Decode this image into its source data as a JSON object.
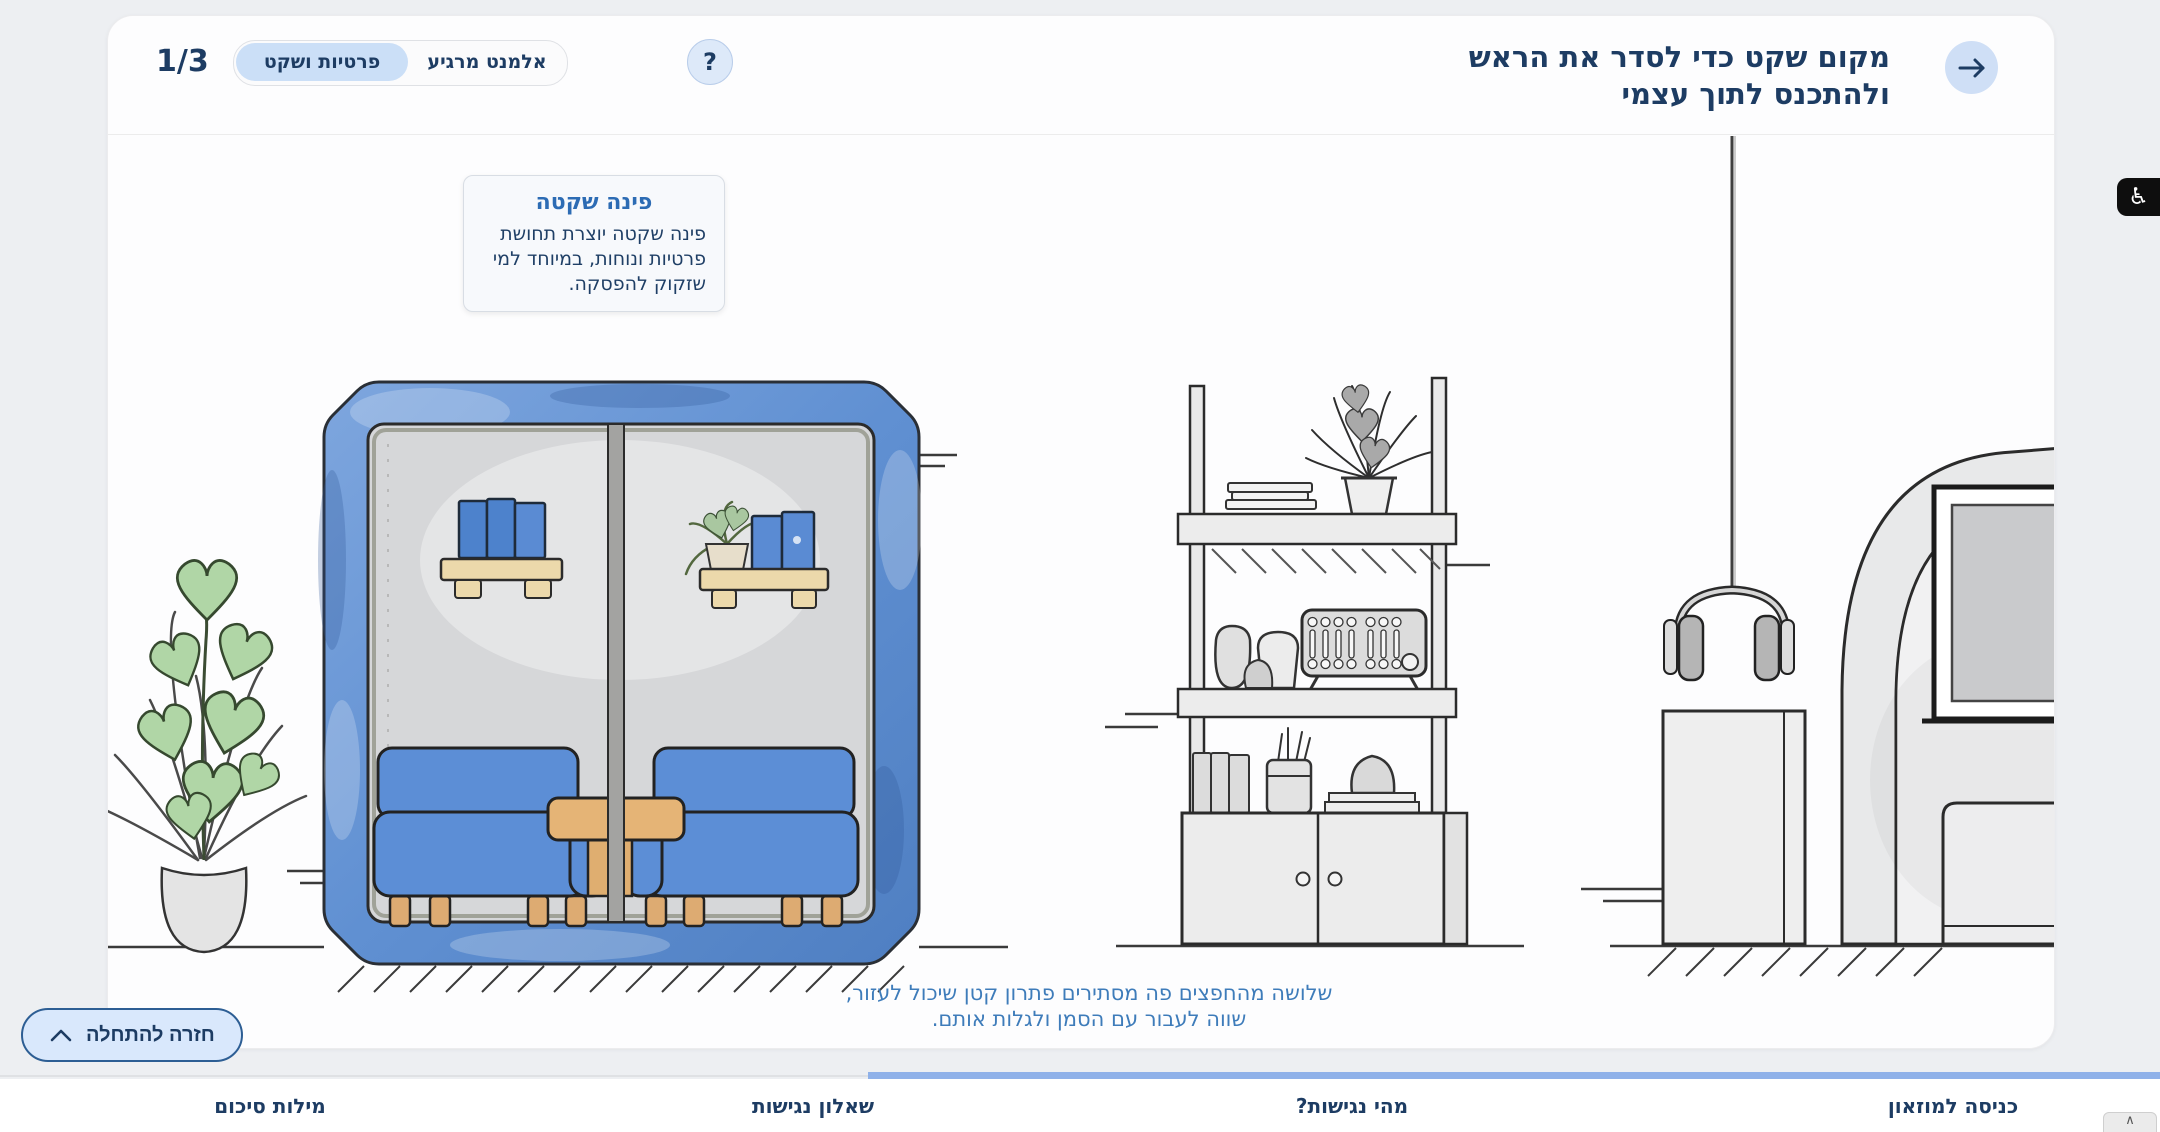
{
  "app": {
    "language": "he",
    "direction": "rtl"
  },
  "colors": {
    "page_bg": "#edeff2",
    "card_bg": "#fdfdfe",
    "primary_text": "#1d3c63",
    "tooltip_title_blue": "#2d6cb4",
    "caption_blue": "#3e7cba",
    "toggle_active_bg": "#cbdff7",
    "back_button_bg": "#d9e8fc",
    "back_button_border": "#2d5e94",
    "progress_blue": "#8fb1e9",
    "booth_blue": "#6090d2"
  },
  "header": {
    "step_counter": "1/3",
    "toggle": {
      "active_label": "פרטיות ושקט",
      "inactive_label": "אלמנט מרגיע"
    },
    "help_label": "?",
    "title_line1": "מקום שקט כדי לסדר את הראש",
    "title_line2": "ולהתכנס לתוך עצמי"
  },
  "tooltip": {
    "title": "פינה שקטה",
    "body": "פינה שקטה יוצרת תחושת פרטיות ונוחות, במיוחד למי שזקוק להפסקה."
  },
  "caption": {
    "line1": "שלושה מהחפצים פה מסתירים פתרון קטן שיכול לעזור,",
    "line2": "שווה לעבור עם הסמן ולגלות אותם."
  },
  "back_button": {
    "label": "חזרה להתחלה"
  },
  "bottom_nav": {
    "items": [
      {
        "label": "כניסה למוזאון"
      },
      {
        "label": "מהי נגישות?"
      },
      {
        "label": "שאלון נגישות"
      },
      {
        "label": "מילות סיכום"
      }
    ]
  },
  "accessibility_widget": {
    "symbol": "♿"
  },
  "scroll_top_button": {
    "symbol": "∧"
  }
}
